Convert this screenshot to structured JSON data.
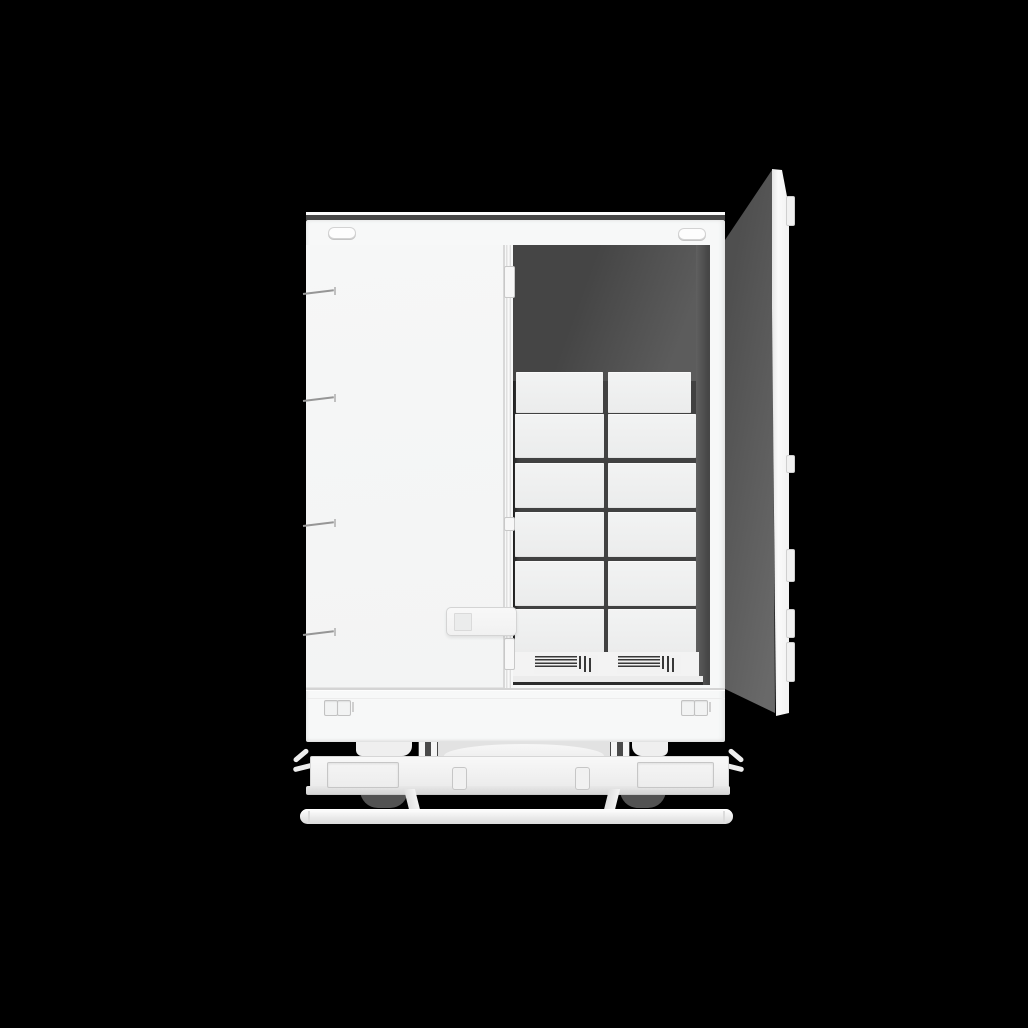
{
  "scene": {
    "description": "3D render on black background: white box truck cargo body seen from the rear, left rear door closed, right rear door swung open revealing a dark interior stacked with white cargo boxes on two pallets",
    "background_color": "#000000"
  },
  "truck": {
    "body_color": "#f6f7f7",
    "roof_line_color": "#474747",
    "marker_light_count": 2,
    "left_door": {
      "state": "closed",
      "hinge_count": 4,
      "has_latch_handle": true,
      "has_lock_rod": true
    },
    "right_door": {
      "state": "open",
      "inner_color": "#5e5e5e",
      "edge_color": "#fafafa",
      "hinge_tab_count": 5
    },
    "cargo": {
      "interior_color": "#4a4a4a",
      "box_color": "#f0f1f1",
      "box_columns": 2,
      "box_rows": 6,
      "box_count_visible": 12,
      "pallet_count": 2
    },
    "tail_light_clusters": 2,
    "lenses_per_cluster": 2,
    "bumper": {
      "step_plates": 2,
      "center_slots": 2,
      "corner_hooks": 2
    },
    "underride_bar": true
  }
}
